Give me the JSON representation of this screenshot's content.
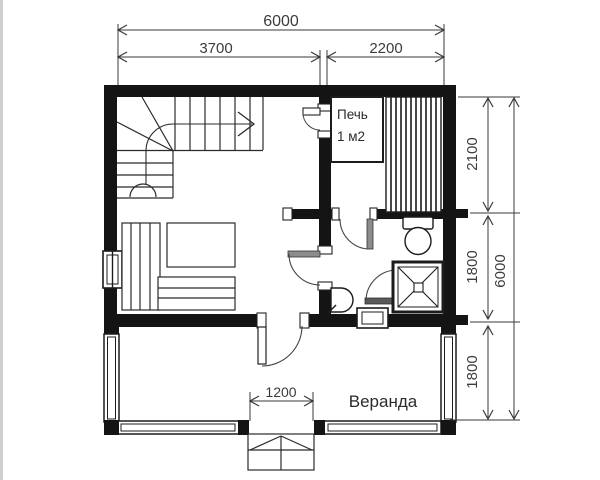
{
  "document": {
    "type": "floor-plan",
    "language": "ru"
  },
  "labels": {
    "veranda": "Веранда",
    "stove_line1": "Печь",
    "stove_line2": "1 м2"
  },
  "dimensions": {
    "top_total": "6000",
    "top_left": "3700",
    "top_right": "2200",
    "right_total": "6000",
    "right_top": "2100",
    "right_middle": "1800",
    "right_bottom": "1800",
    "entrance_width": "1200"
  },
  "fixtures": [
    "stairs",
    "stove",
    "sauna-bench",
    "bed-bench",
    "toilet",
    "shower-cabin",
    "corner-sink",
    "entrance-steps",
    "window",
    "door"
  ],
  "colors": {
    "walls": "#141414",
    "lines": "#2b2b2b",
    "dimension_lines": "#3a3a3a",
    "dimension_text": "#3c3c3c",
    "door_leaf_gray": "#8c8c8c",
    "background": "#ffffff"
  }
}
